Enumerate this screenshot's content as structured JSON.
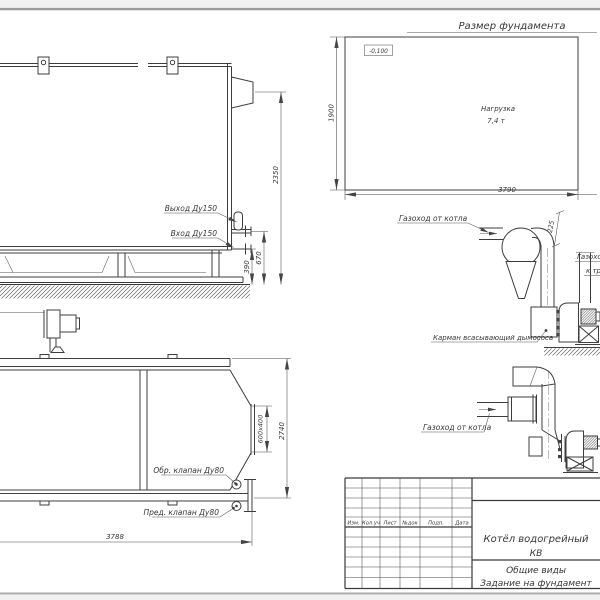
{
  "foundation_plan": {
    "title": "Размер фундамента",
    "elevation_mark": "-0,100",
    "load_line1": "Нагрузка",
    "load_line2": "7,4 т",
    "dim_width": "3790",
    "dim_height": "1900"
  },
  "side_view": {
    "outlet_label": "Выход Ду150",
    "inlet_label": "Вход Ду150",
    "dim_total": "2350",
    "dim_outlet": "670",
    "dim_inlet": "390"
  },
  "plan_view": {
    "check_valve_label": "Обр. клапан Ду80",
    "safety_valve_label": "Пред. клапан Ду80",
    "dim_length": "3788",
    "dim_width": "2740",
    "dim_flange": "600x400"
  },
  "flue_upper": {
    "from_boiler_label": "Газоход от котла",
    "dim_flange": "225",
    "pocket_label": "Карман всасывающий дымососа",
    "to_chimney_line1": "Газоход",
    "to_chimney_line2": "к трубе"
  },
  "flue_lower": {
    "from_boiler_label": "Газоход от котла"
  },
  "title_block": {
    "columns": [
      "Изм.",
      "Кол.уч",
      "Лист",
      "№док",
      "Подп.",
      "Дата"
    ],
    "product_line1": "Котёл водогрейный",
    "product_line2": "КВ",
    "doc_line1": "Общие виды",
    "doc_line2": "Задание на фундамент"
  }
}
